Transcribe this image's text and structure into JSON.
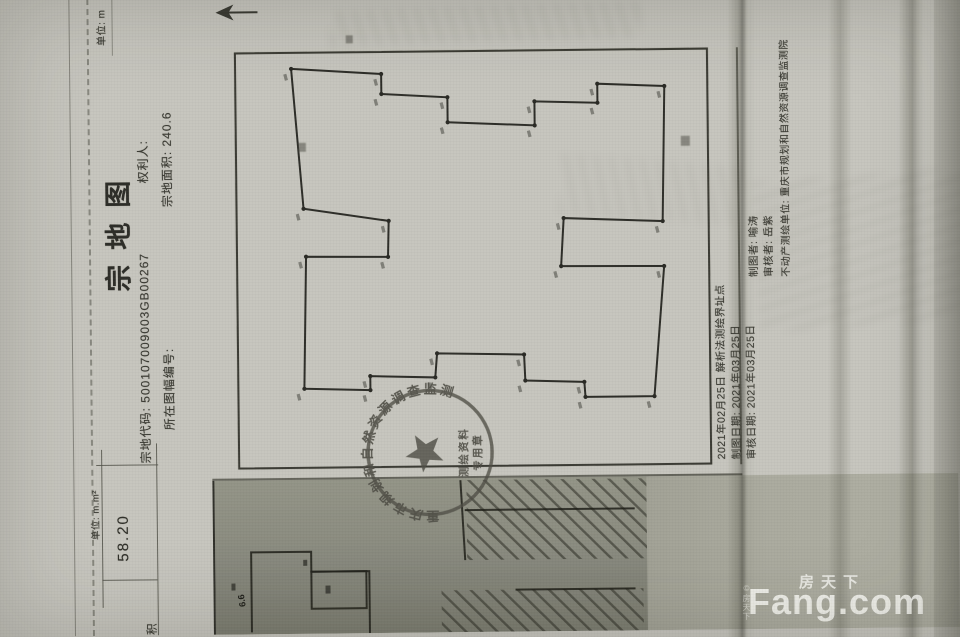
{
  "parcel_sheet": {
    "unit_note": "单位: m",
    "title": "宗地图",
    "header": {
      "parcel_code_label": "宗地代码:",
      "parcel_code": "500107009003GB00267",
      "rights_holder_label": "权利人:",
      "sheet_number_label": "所在图幅编号:",
      "parcel_area_label": "宗地面积:",
      "parcel_area": "240.6"
    },
    "map": {
      "polygon_points": [
        [
          565,
          297
        ],
        [
          559,
          387
        ],
        [
          539,
          387
        ],
        [
          535,
          453
        ],
        [
          510,
          453
        ],
        [
          506,
          540
        ],
        [
          530,
          540
        ],
        [
          528,
          603
        ],
        [
          547,
          603
        ],
        [
          544,
          670
        ],
        [
          409,
          667
        ],
        [
          413,
          568
        ],
        [
          365,
          565
        ],
        [
          364,
          668
        ],
        [
          234,
          657
        ],
        [
          234,
          588
        ],
        [
          249,
          587
        ],
        [
          251,
          528
        ],
        [
          277,
          527
        ],
        [
          279,
          440
        ],
        [
          255,
          438
        ],
        [
          257,
          373
        ],
        [
          243,
          373
        ],
        [
          245,
          307
        ],
        [
          377,
          310
        ],
        [
          376,
          392
        ],
        [
          412,
          393
        ],
        [
          425,
          308
        ]
      ]
    },
    "seal": {
      "ring_text": "重庆市规划和自然资源调查监测院",
      "line1": "测绘资料",
      "line2": "专用章"
    },
    "footer_left": [
      "2021年02月25日 解析法测绘界址点",
      "制图日期: 2021年03月25日",
      "审核日期: 2021年03月25日"
    ],
    "footer_right": [
      "制图者: 喻涛",
      "审核者: 岳紫",
      "不动产测绘单位: 重庆市规划和自然资源调查监测院"
    ]
  },
  "adjacent_sheet": {
    "unit_label": "单位: m.m²",
    "area_value": "58.20",
    "row_label": "面积",
    "dim_label": "6.6"
  },
  "watermark": {
    "brand_cn": "房天下",
    "brand_en": "Fang.com",
    "copyright": "©房天下"
  }
}
